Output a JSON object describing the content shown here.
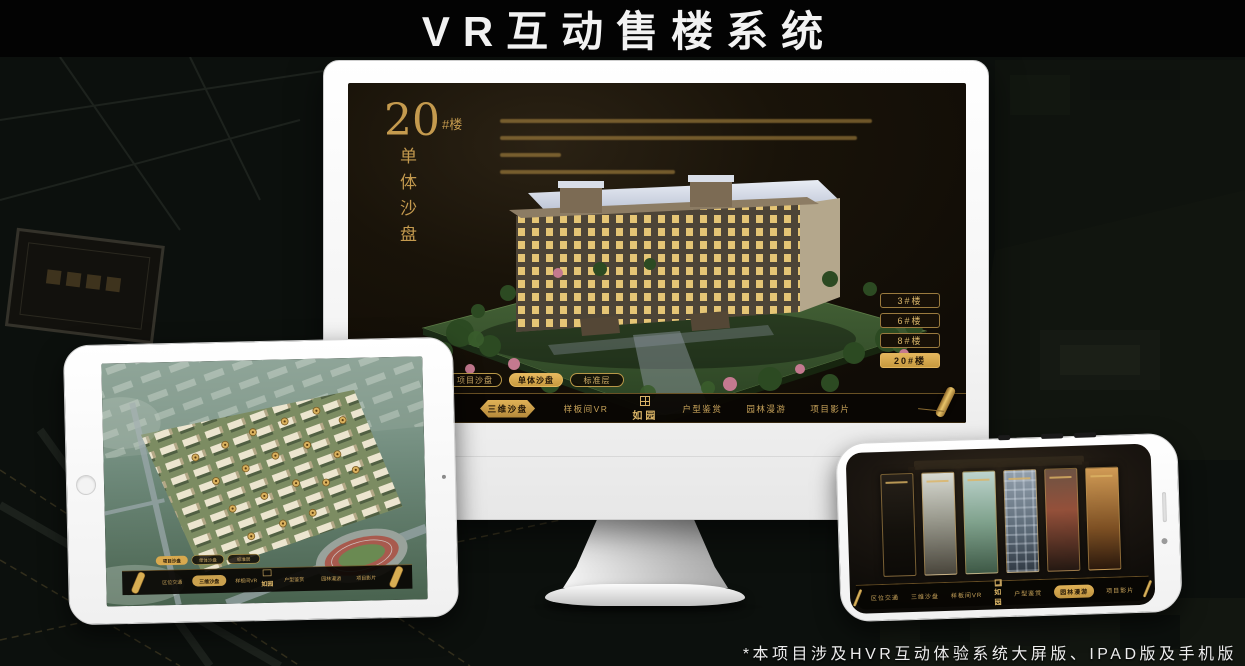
{
  "page": {
    "title": "VR互动售楼系统",
    "footnote": "*本项目涉及HVR互动体验系统大屏版、IPAD版及手机版"
  },
  "colors": {
    "gold": "#C9A355",
    "gold_bright": "#E3B55C",
    "active_gold_text": "#221607",
    "screen_bg": "#14100A",
    "device_body": "#FFFFFF"
  },
  "nav": {
    "logo": "如园",
    "items": [
      "区位交通",
      "三维沙盘",
      "样板间VR",
      "户型鉴赏",
      "园林漫游",
      "项目影片"
    ]
  },
  "sub_tabs": [
    "项目沙盘",
    "单体沙盘",
    "标准层"
  ],
  "monitor_ui": {
    "heading_number": "20",
    "heading_unit": "#楼",
    "heading_vertical": "单体沙盘",
    "floor_buttons": [
      "3#楼",
      "6#楼",
      "8#楼",
      "20#楼"
    ],
    "active_floor": "20#楼",
    "active_sub_tab": "单体沙盘",
    "active_nav": "三维沙盘"
  },
  "tablet_ui": {
    "active_sub_tab": "项目沙盘",
    "active_nav": "三维沙盘"
  },
  "phone_ui": {
    "active_nav": "园林漫游",
    "gallery_card_count": 6
  }
}
